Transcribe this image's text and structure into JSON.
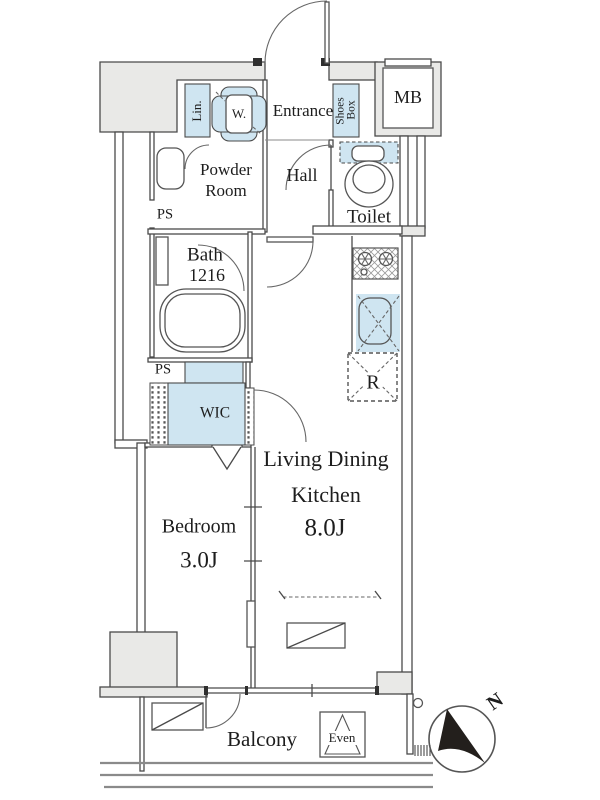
{
  "colors": {
    "accent_blue": "#cfe5f1",
    "wall_gray": "#e9e9e7",
    "line": "#4a4a4a",
    "text": "#1d1d1d"
  },
  "rooms": {
    "entrance": {
      "label": "Entrance"
    },
    "hall": {
      "label": "Hall"
    },
    "powder_room": {
      "line1": "Powder",
      "line2": "Room"
    },
    "toilet": {
      "label": "Toilet"
    },
    "bath": {
      "label": "Bath",
      "size": "1216"
    },
    "wic": {
      "label": "WIC"
    },
    "bedroom": {
      "label": "Bedroom",
      "size": "3.0J"
    },
    "ldk": {
      "line1": "Living Dining",
      "line2": "Kitchen",
      "size": "8.0J"
    },
    "balcony": {
      "label": "Balcony"
    }
  },
  "fixtures": {
    "meter_box": "MB",
    "pipe_space_upper": "PS",
    "pipe_space_lower": "PS",
    "linen_cabinet": "Lin.",
    "washer": "W.",
    "shoes_box_line1": "Shoes",
    "shoes_box_line2": "Box",
    "refrigerator_space": "R",
    "evacuation_hatch": "Even"
  },
  "compass": {
    "north_label": "N"
  }
}
